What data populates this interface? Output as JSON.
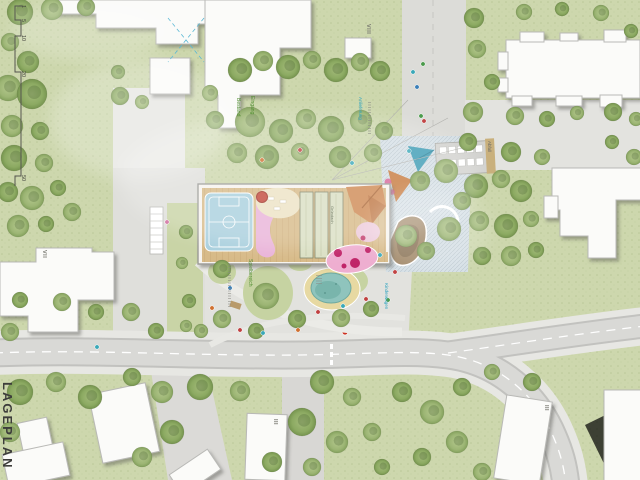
{
  "plan": {
    "title": "LAGEPLAN"
  },
  "scale_bar": {
    "ticks": [
      "1",
      "5",
      "10",
      "20",
      "50"
    ]
  },
  "building_labels": {
    "slab_north": "VIII",
    "block_west": "VII",
    "rowhouse_center": "III",
    "rowhouse_southeast": "III"
  },
  "annotations": {
    "existing_trees": "Bestand",
    "entrance": "Eingang",
    "delivery": "Anlieferung",
    "stroller_parking": "Kinderwagen",
    "waste": "Abfall",
    "play_area": "Spielbereich",
    "green_roof": "Gründach"
  },
  "palette": {
    "lawn": "#cdd7ad",
    "tree_green": "#8caa62",
    "paving": "#d9d9d6",
    "building_white": "#fbfbf9",
    "water": "#8fc4bd",
    "sand": "#e7d9a2",
    "play_pink": "#eeaed0",
    "accent_orange": "#cf8a55",
    "roof_green": "#dadfc3",
    "court_blue": "#a9cfdd",
    "label_green": "#4e8c2f",
    "label_cyan": "#29a3c0"
  }
}
